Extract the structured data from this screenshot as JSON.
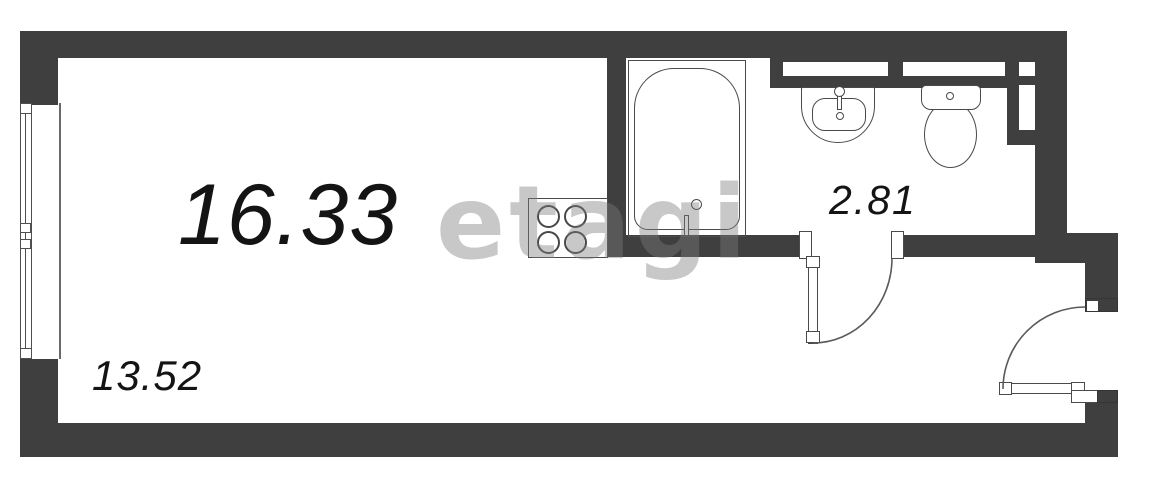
{
  "plan": {
    "title": "studio apartment floor plan",
    "watermark": "etagi",
    "rooms": [
      {
        "id": "main-room",
        "area_label": "16.33"
      },
      {
        "id": "main-room-part",
        "area_label": "13.52"
      },
      {
        "id": "bathroom",
        "area_label": "2.81"
      }
    ],
    "fixtures": [
      "bathtub",
      "sink",
      "toilet",
      "stove",
      "window",
      "bathroom-door",
      "entrance-door"
    ]
  },
  "colors": {
    "wall": "#3f3f3f",
    "fixture_line": "#4a4a4a",
    "label_text": "#141414",
    "watermark_gray": "#7d7d7d",
    "background": "#ffffff"
  }
}
